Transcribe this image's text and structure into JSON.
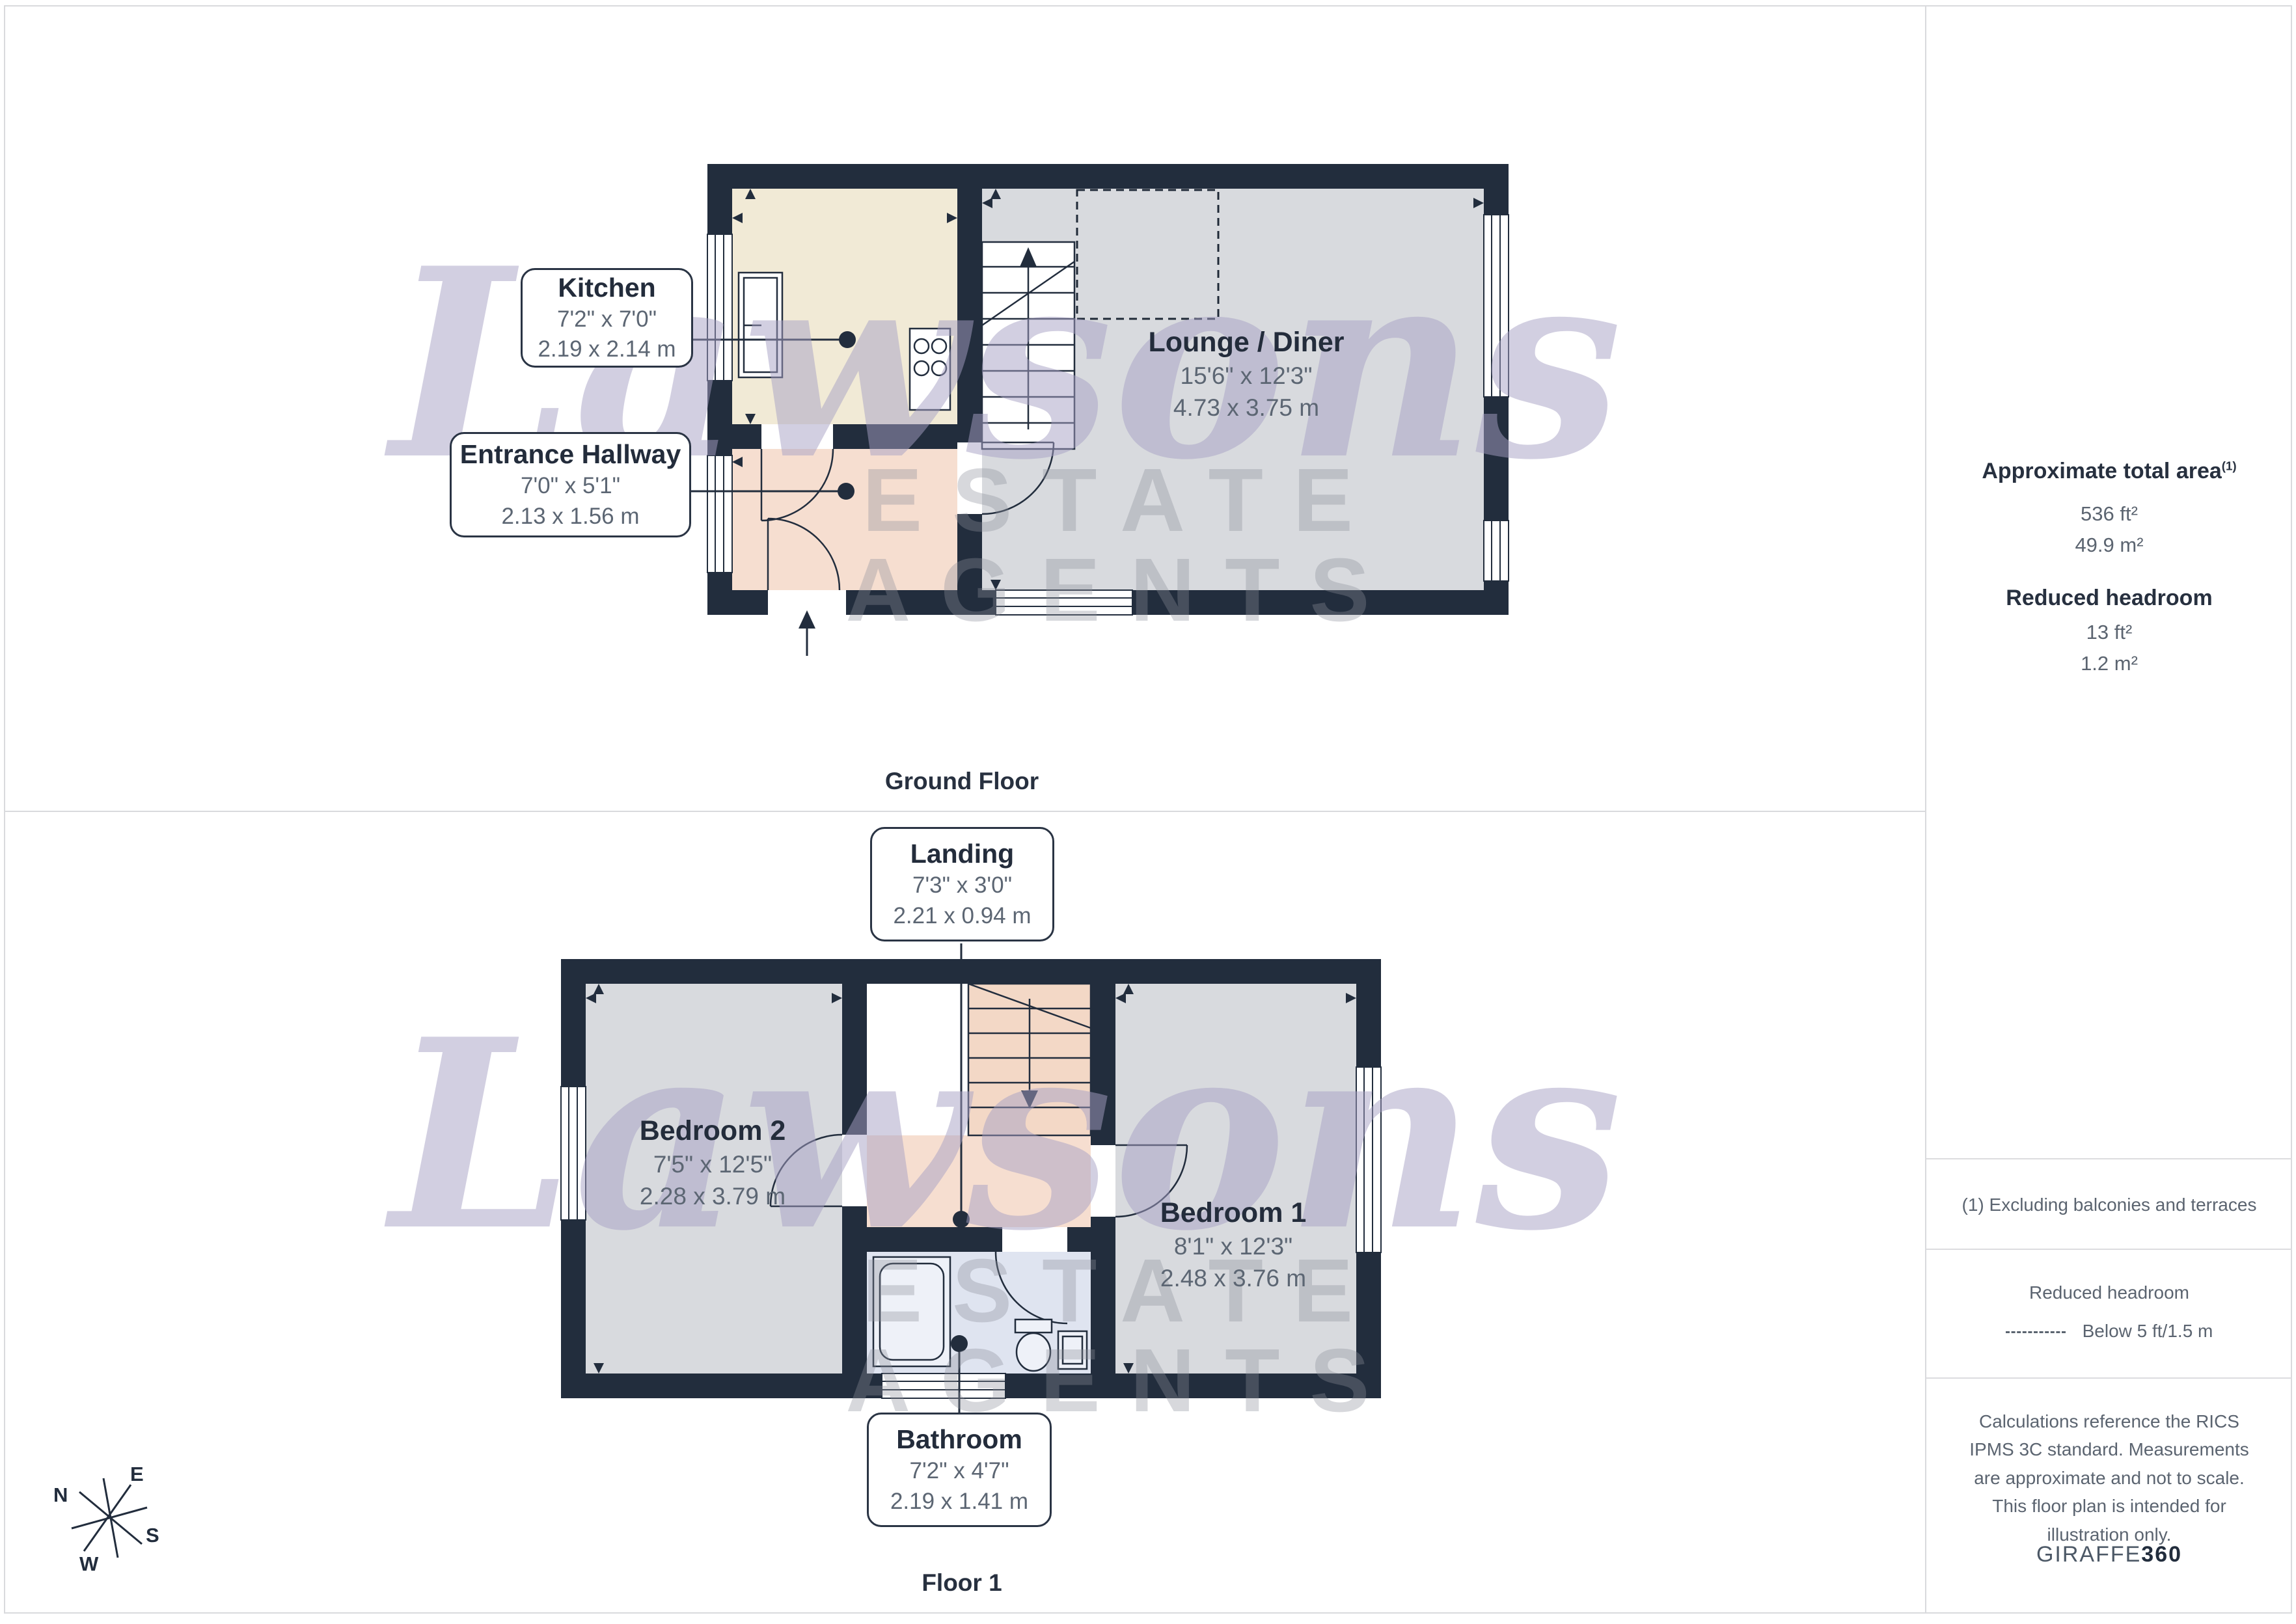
{
  "watermark": {
    "script": "Lawsons",
    "caps": "ESTATE AGENTS"
  },
  "ground_floor": {
    "caption": "Ground Floor",
    "kitchen": {
      "name": "Kitchen",
      "imperial": "7'2\" x 7'0\"",
      "metric": "2.19 x 2.14 m"
    },
    "hallway": {
      "name": "Entrance Hallway",
      "imperial": "7'0\" x 5'1\"",
      "metric": "2.13 x 1.56 m"
    },
    "lounge": {
      "name": "Lounge / Diner",
      "imperial": "15'6\" x 12'3\"",
      "metric": "4.73 x 3.75 m"
    }
  },
  "floor_1": {
    "caption": "Floor 1",
    "landing": {
      "name": "Landing",
      "imperial": "7'3\" x 3'0\"",
      "metric": "2.21 x 0.94 m"
    },
    "bedroom2": {
      "name": "Bedroom 2",
      "imperial": "7'5\" x 12'5\"",
      "metric": "2.28 x 3.79 m"
    },
    "bedroom1": {
      "name": "Bedroom 1",
      "imperial": "8'1\" x 12'3\"",
      "metric": "2.48 x 3.76 m"
    },
    "bathroom": {
      "name": "Bathroom",
      "imperial": "7'2\" x 4'7\"",
      "metric": "2.19 x 1.41 m"
    }
  },
  "sidebar": {
    "area_heading": "Approximate total area",
    "area_sup": "(1)",
    "area_ft": "536 ft²",
    "area_m": "49.9 m²",
    "reduced_heading": "Reduced headroom",
    "reduced_ft": "13 ft²",
    "reduced_m": "1.2 m²",
    "footnote": "(1) Excluding balconies and terraces",
    "legend_heading": "Reduced headroom",
    "legend_label": "Below 5 ft/1.5 m",
    "disclaimer": "Calculations reference the RICS IPMS 3C standard. Measurements are approximate and not to scale. This floor plan is intended for illustration only.",
    "credit_regular": "GIRAFFE",
    "credit_bold": "360"
  },
  "compass": {
    "n": "N",
    "e": "E",
    "s": "S",
    "w": "W"
  },
  "colors": {
    "wall": "#222d3d",
    "room_gray": "#d8dade",
    "kitchen_cream": "#f1ead6",
    "hall_pink": "#f6ded0",
    "bathroom_blue": "#dfe4f0",
    "watermark_purple": "#a69fc4"
  }
}
